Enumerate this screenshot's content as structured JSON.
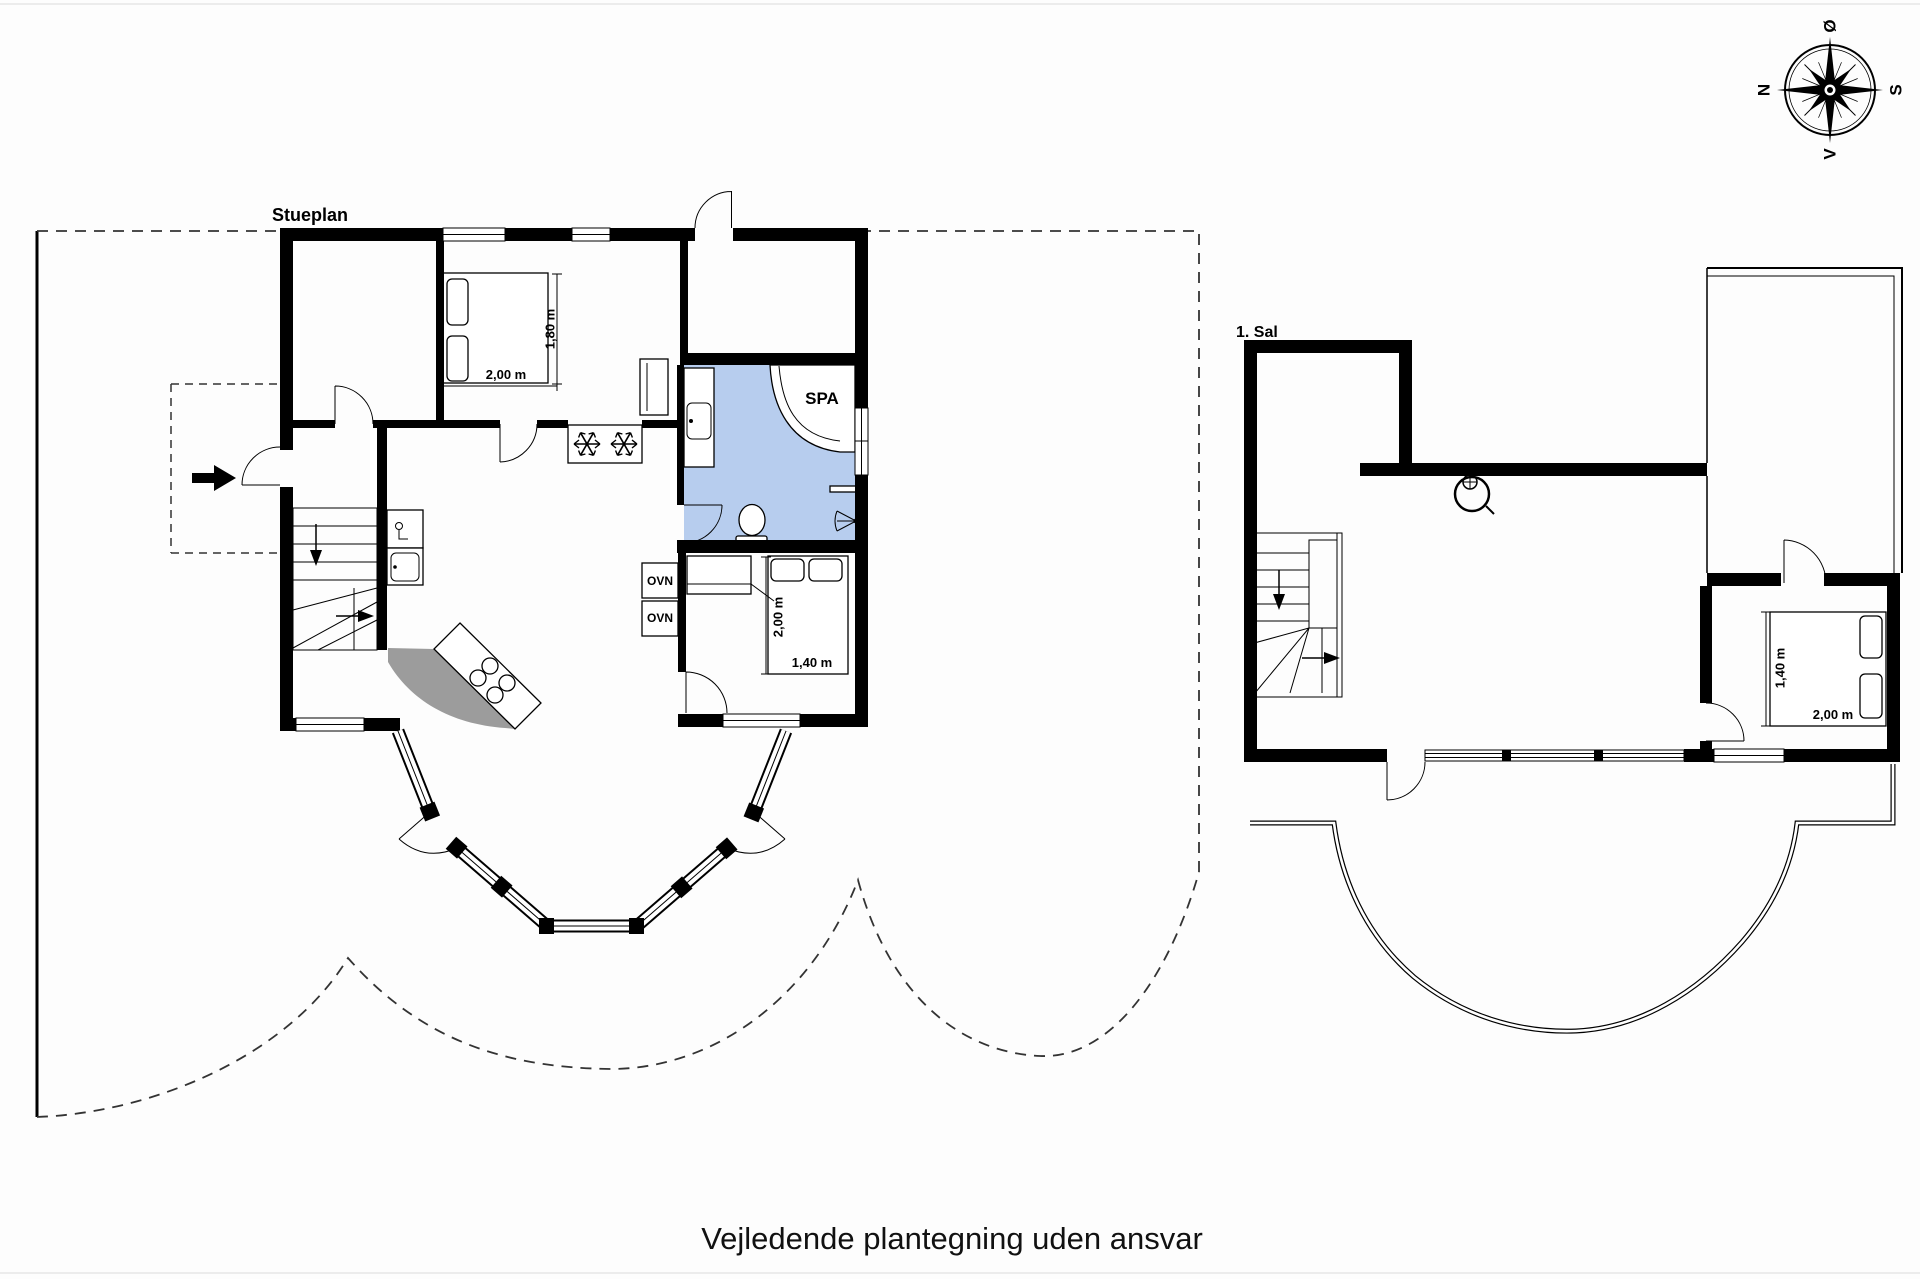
{
  "meta": {
    "footer_disclaimer": "Vejledende plantegning uden ansvar"
  },
  "compass": {
    "north_label": "N",
    "south_label": "S",
    "east_label": "Ø",
    "west_label": "V"
  },
  "ground_floor": {
    "title": "Stueplan",
    "labels": {
      "spa": "SPA",
      "oven_upper": "OVN",
      "oven_lower": "OVN"
    },
    "bed_double": {
      "length": "2,00 m",
      "width": "1,80 m"
    },
    "bed_small": {
      "length": "2,00 m",
      "width": "1,40 m"
    }
  },
  "first_floor": {
    "title": "1. Sal",
    "bed": {
      "length": "2,00 m",
      "width": "1,40 m"
    }
  },
  "icons": {
    "compass": "compass-rose-icon",
    "freezer": "snowflake-icon",
    "stove": "wood-stove-icon",
    "entrance": "entrance-arrow-icon"
  },
  "colors": {
    "bathroom_fill": "#b7cdee",
    "shadow": "#9c9c9c",
    "ink": "#000000",
    "dash": "#333333",
    "page_bg": "#fdfdfd"
  }
}
